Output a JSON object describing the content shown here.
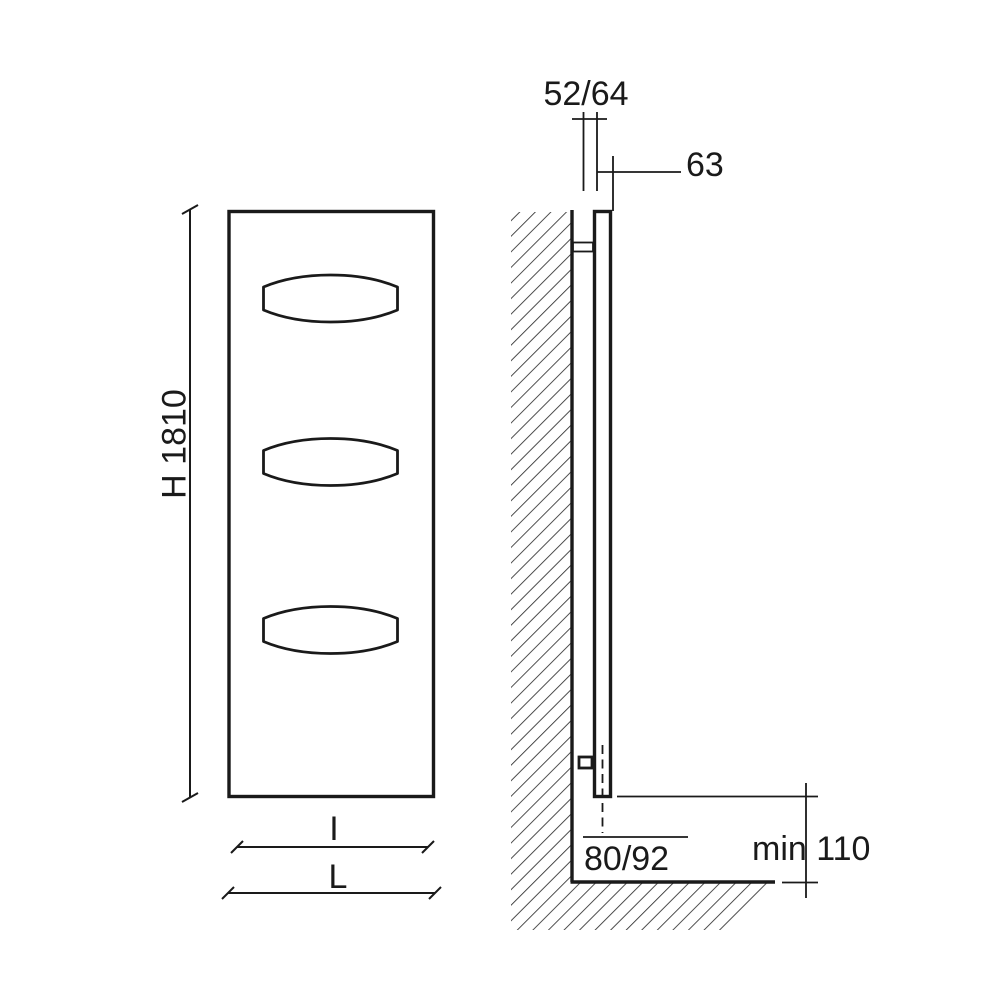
{
  "front_view": {
    "height_label": "H 1810",
    "inner_width_label": "I",
    "overall_width_label": "L"
  },
  "side_view": {
    "depth_label": "52/64",
    "wall_offset_label": "63",
    "pipe_axis_label": "80/92",
    "floor_clearance_label": "min 110"
  },
  "colors": {
    "line": "#1a1a1a",
    "background": "#ffffff"
  }
}
